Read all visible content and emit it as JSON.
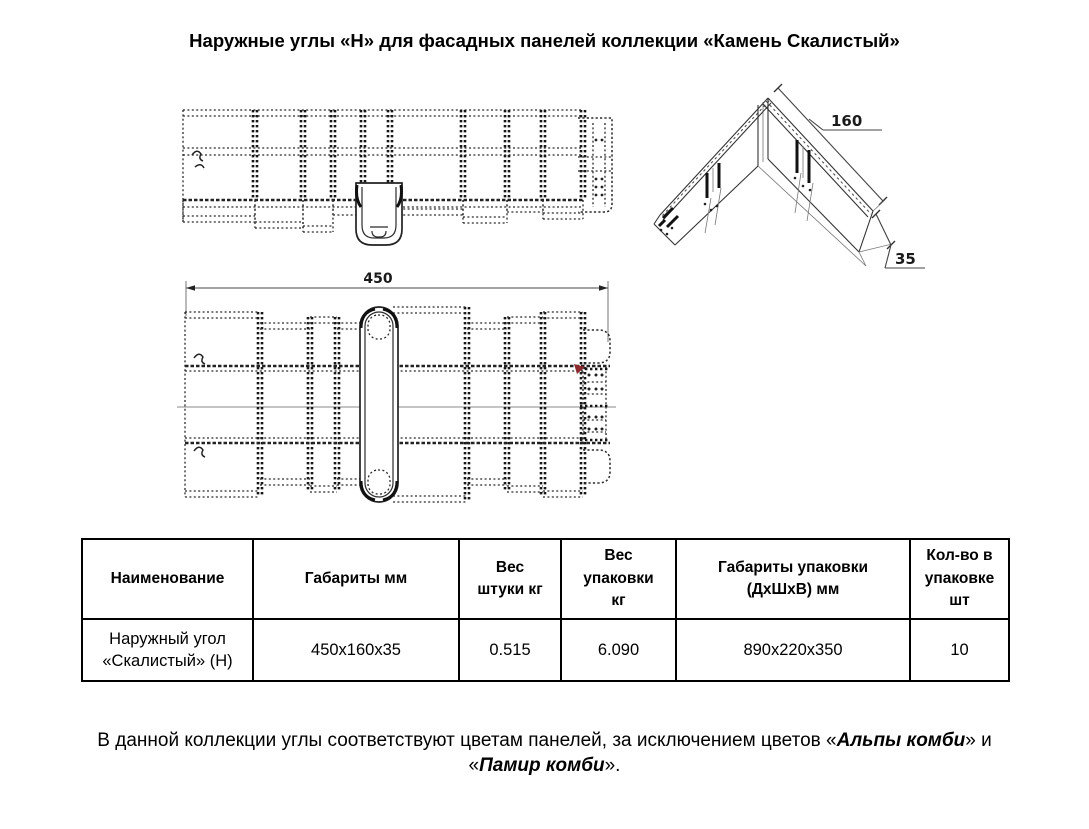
{
  "title": "Наружные углы «Н» для фасадных панелей коллекции «Камень Скалистый»",
  "drawings": {
    "plan_dim_length": "450",
    "iso_dim_width": "160",
    "iso_dim_thickness": "35"
  },
  "colors": {
    "marker_red": "#8b2a2e"
  },
  "table": {
    "headers": [
      "Наименование",
      "Габариты мм",
      "Вес\nштуки кг",
      "Вес\nупаковки\nкг",
      "Габариты упаковки\n(ДхШхВ) мм",
      "Кол-во в\nупаковке\nшт"
    ],
    "row": {
      "name": "Наружный угол\n«Скалистый» (Н)",
      "dimensions": "450х160х35",
      "unit_weight": "0.515",
      "pack_weight": "6.090",
      "pack_dimensions": "890х220х350",
      "pack_qty": "10"
    }
  },
  "note": {
    "line1_pre": "В данной коллекции углы соответствуют цветам панелей, за исключением цветов «",
    "color1": "Альпы комби",
    "line1_post": "» и",
    "line2_pre": "«",
    "color2": "Памир комби",
    "line2_post": "»."
  }
}
